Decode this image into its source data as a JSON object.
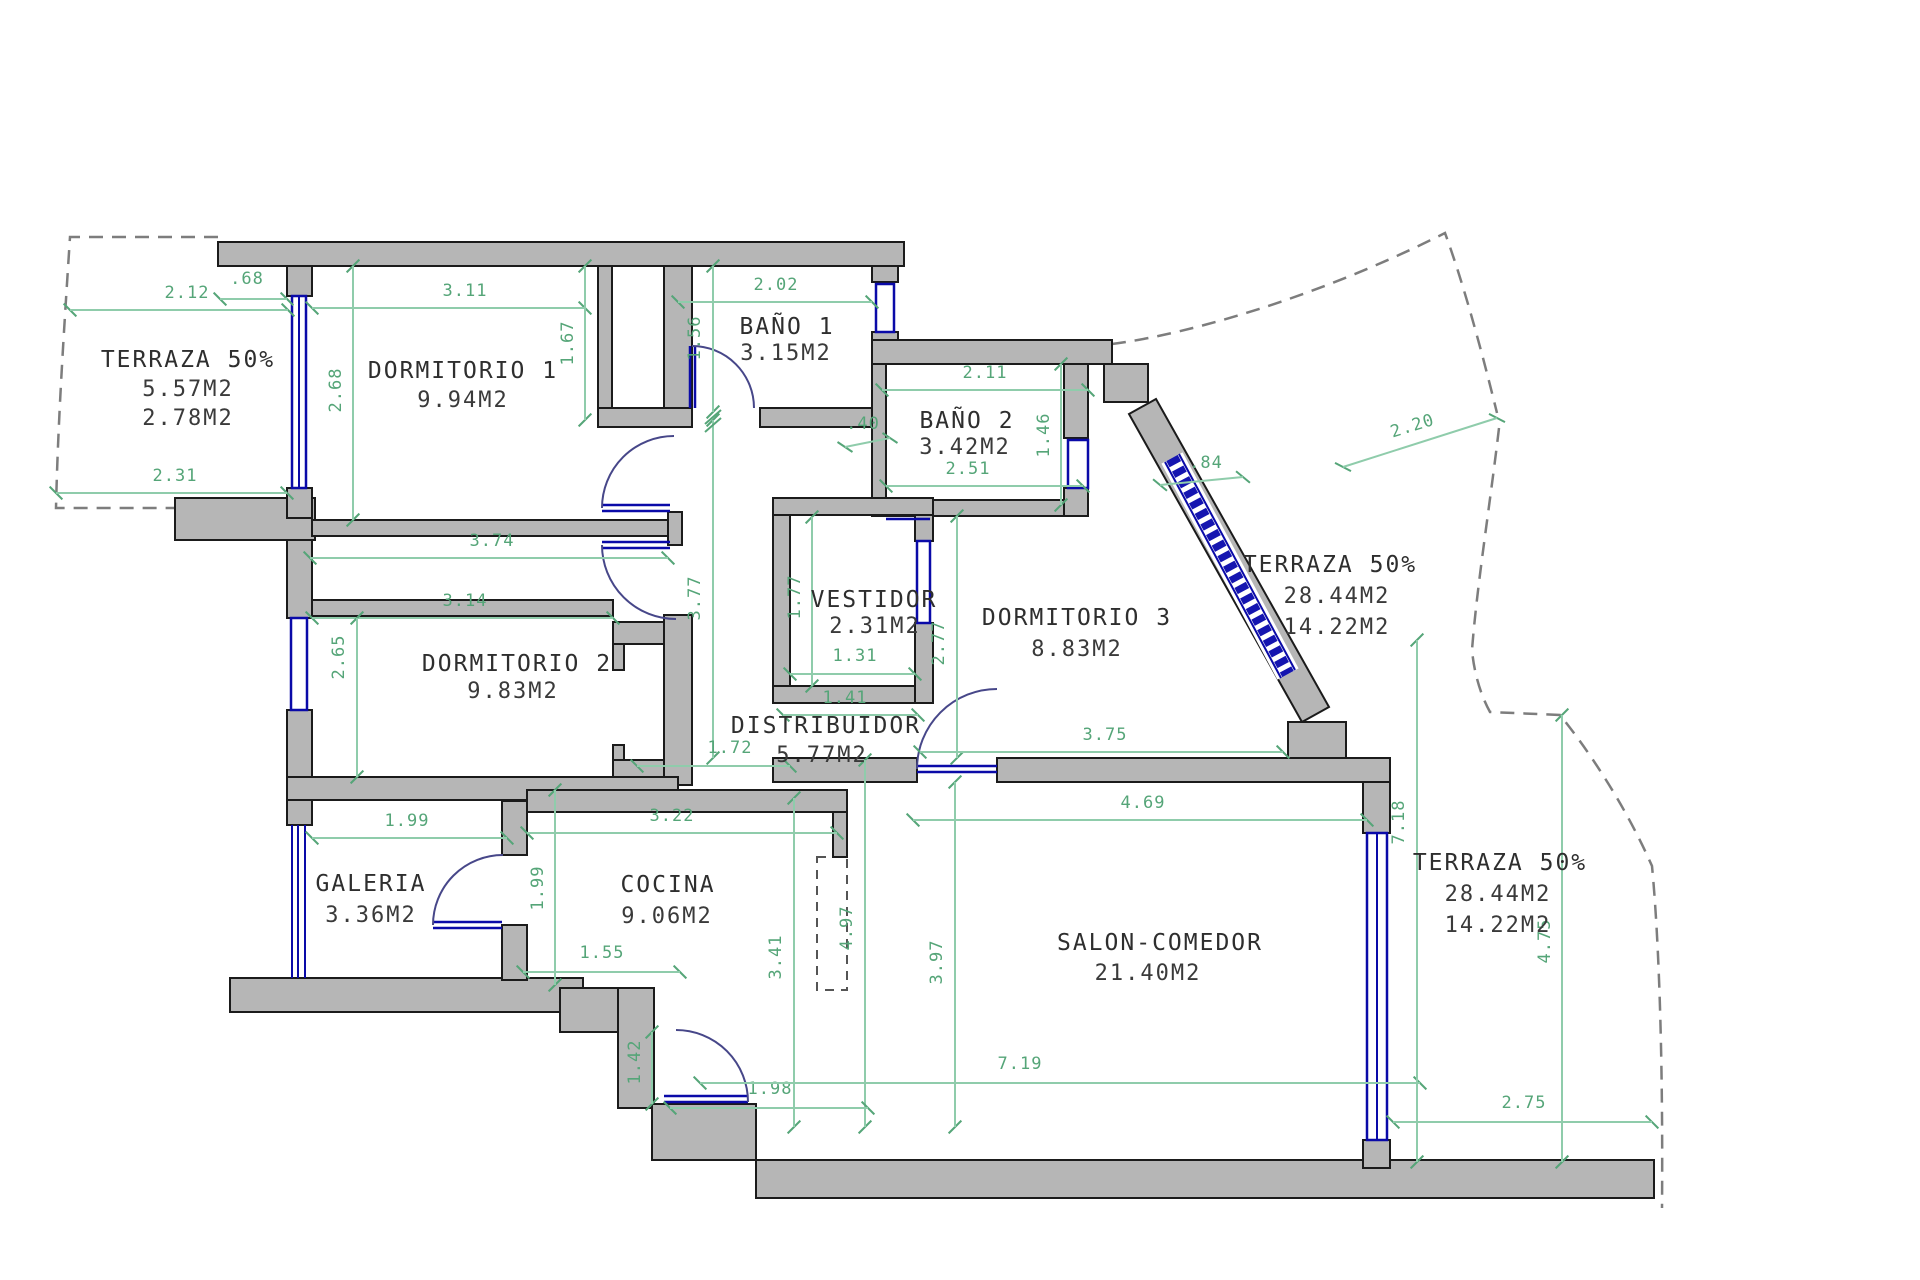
{
  "rooms": {
    "terraza_nw": {
      "name": "TERRAZA 50%",
      "area1": "5.57M2",
      "area2": "2.78M2"
    },
    "dormitorio1": {
      "name": "DORMITORIO 1",
      "area": "9.94M2"
    },
    "bano1": {
      "name": "BAÑO 1",
      "area": "3.15M2"
    },
    "bano2": {
      "name": "BAÑO 2",
      "area": "3.42M2"
    },
    "dormitorio3": {
      "name": "DORMITORIO 3",
      "area": "8.83M2"
    },
    "terraza_ne": {
      "name": "TERRAZA 50%",
      "area1": "28.44M2",
      "area2": "14.22M2"
    },
    "vestidor": {
      "name": "VESTIDOR",
      "area": "2.31M2"
    },
    "distribuidor": {
      "name": "DISTRIBUIDOR",
      "area": "5.77M2"
    },
    "dormitorio2": {
      "name": "DORMITORIO 2",
      "area": "9.83M2"
    },
    "galeria": {
      "name": "GALERIA",
      "area": "3.36M2"
    },
    "cocina": {
      "name": "COCINA",
      "area": "9.06M2"
    },
    "salon": {
      "name": "SALON-COMEDOR",
      "area": "21.40M2"
    },
    "terraza_se": {
      "name": "TERRAZA 50%",
      "area1": "28.44M2",
      "area2": "14.22M2"
    }
  },
  "dims": {
    "nw_top": "2.12",
    "nw_win": ".68",
    "nw_bot": "2.31",
    "d1_w": "3.11",
    "d1_h": "2.68",
    "d1_closet_h": "1.67",
    "b1_w": "2.02",
    "b1_h": "1.56",
    "hall_h": "3.77",
    "b2_w_top": "2.11",
    "b2_w_bot": "2.51",
    "b2_h": "1.46",
    "b2_nub": ".40",
    "ne_wall": ".84",
    "ne_edge": "2.20",
    "strip_w": "3.74",
    "d2_w": "3.14",
    "d2_h": "2.65",
    "vest_h": "1.77",
    "vest_w": "1.31",
    "d3_h": "2.77",
    "pass_w": "1.41",
    "dist_w": "1.72",
    "d3_w": "3.75",
    "salon_w_top": "4.69",
    "cocina_w": "3.22",
    "gal_w": "1.99",
    "cocina_h": "1.99",
    "cocina_bot": "1.55",
    "dist_h": "3.41",
    "hall2_h": "4.97",
    "salon_h": "3.97",
    "entry_h": "1.42",
    "entry_w": "1.98",
    "salon_w_bot": "7.19",
    "se_bot": "2.75",
    "se_h": "7.18",
    "se_h2": "4.75"
  },
  "colors": {
    "wall": "#b6b6b6",
    "dimension": "#55a578",
    "window": "#0a0aa8",
    "text": "#2e2e2e"
  }
}
